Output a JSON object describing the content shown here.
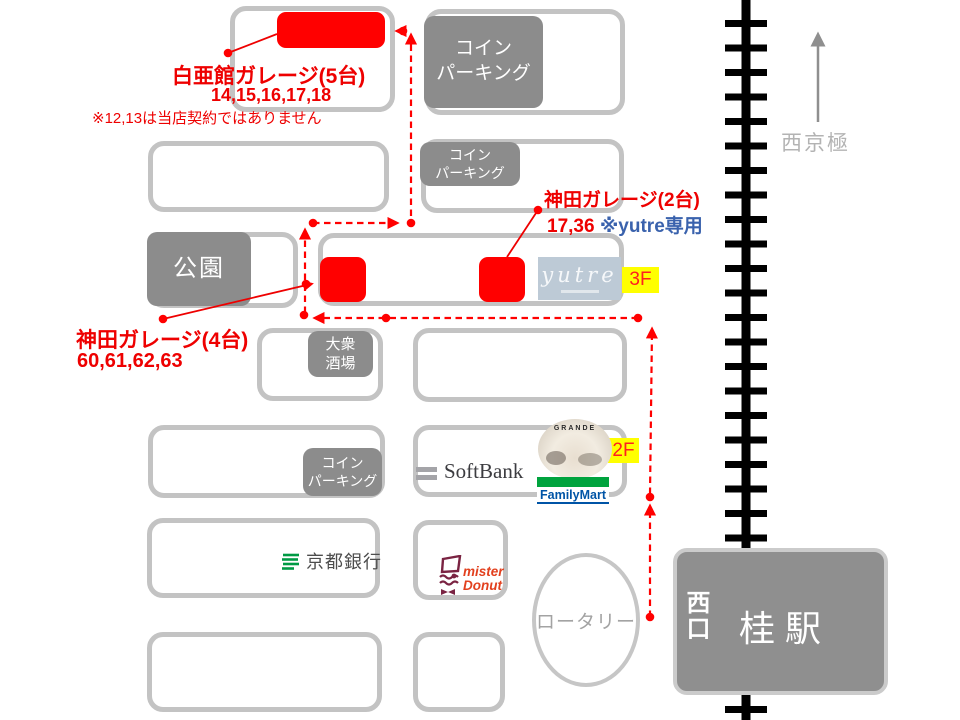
{
  "garages": {
    "hakua": {
      "title": "白亜館ガレージ(5台)",
      "numbers": "14,15,16,17,18",
      "note": "※12,13は当店契約ではありません"
    },
    "kanda2": {
      "title": "神田ガレージ(2台)",
      "numbers": "17,36",
      "note": "※yutre専用"
    },
    "kanda4": {
      "title": "神田ガレージ(4台)",
      "numbers": "60,61,62,63"
    }
  },
  "places": {
    "coin_parking": "コイン\nパーキング",
    "park": "公園",
    "izakaya": "大衆\n酒場",
    "yutre": "yutre",
    "grande": "GRANDE",
    "softbank": "SoftBank",
    "familymart": "FamilyMart",
    "kyoto_bank": "京都銀行",
    "mister_donut": "mister\nDonut",
    "rotary": "ロータリー",
    "station": "桂駅",
    "west_exit": "西口",
    "direction": "西京極",
    "floor2": "2F",
    "floor3": "3F"
  },
  "colors": {
    "route_red": "#ff0000",
    "note_blue": "#3a62ad",
    "floor_yellow": "#ffff00",
    "landmark_gray": "#8c8c8c",
    "building_border": "#c3c3c3"
  }
}
